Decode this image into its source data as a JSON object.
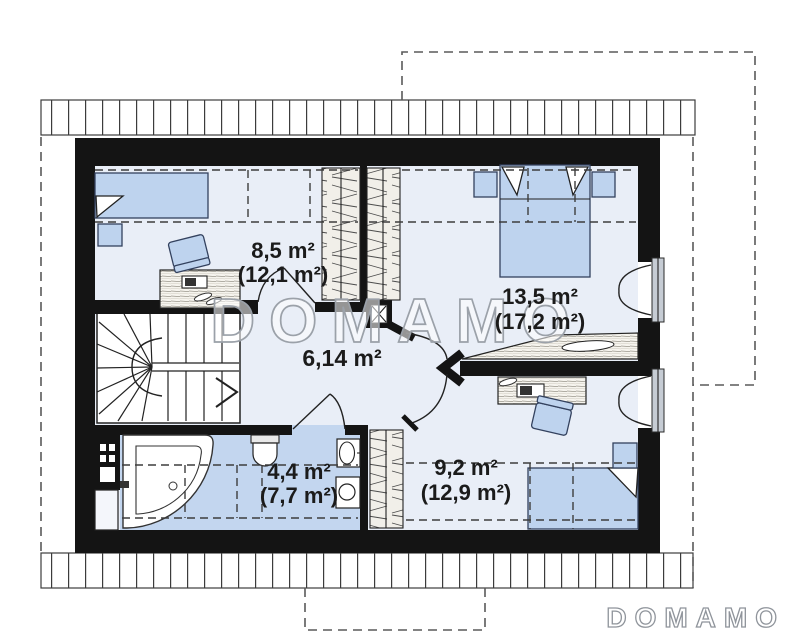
{
  "plan": {
    "watermark_text": "DOMAMO",
    "brand_logo_text": "DOMAMO",
    "rooms": {
      "bedroom_small": {
        "area": "8,5 m²",
        "area_gross": "(12,1 m²)"
      },
      "bedroom_master": {
        "area": "13,5 m²",
        "area_gross": "(17,2 m²)"
      },
      "hall": {
        "area": "6,14 m²"
      },
      "bathroom": {
        "area": "4,4 m²",
        "area_gross": "(7,7 m²)"
      },
      "bedroom_second": {
        "area": "9,2 m²",
        "area_gross": "(12,9 m²)"
      }
    },
    "colors": {
      "wall": "#141414",
      "room_floor": "#e9eef7",
      "bathroom_floor": "#c3d6ef",
      "furniture_fill": "#bed3ee",
      "window_frame": "#c6ccd4",
      "watermark_outline": "#9ba1a9",
      "label_text": "#1b1b1b"
    }
  }
}
